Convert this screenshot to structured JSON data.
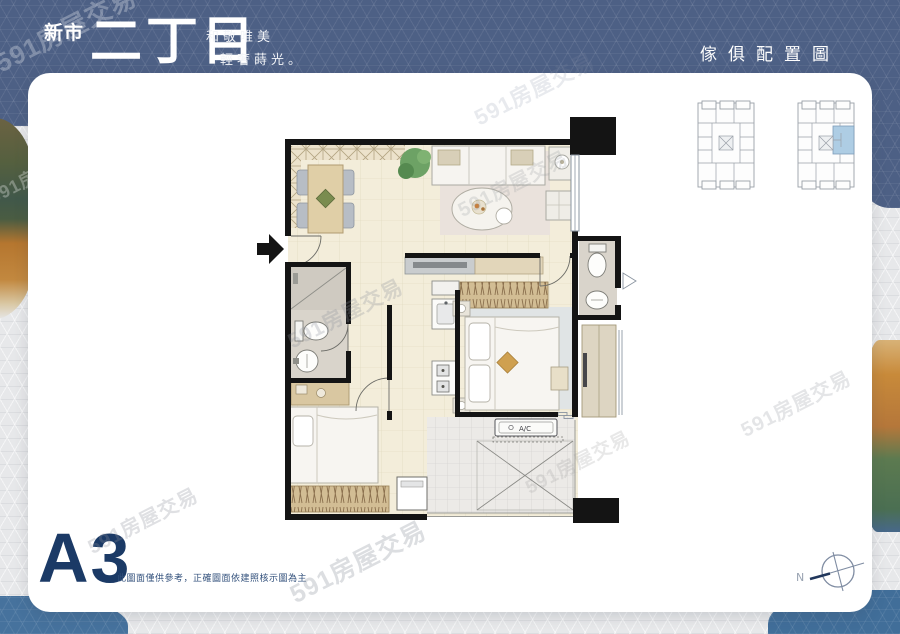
{
  "banner": {
    "location": "新市",
    "name": "二丁目",
    "slogan1": "和敬唯美",
    "slogan2": "輕奢蒔光。",
    "right_title": "傢俱配置圖"
  },
  "footer": {
    "unit": "A3",
    "disclaimer": "此圖面僅供參考，正確圖面依建照核示圖為主",
    "compass_label": "N"
  },
  "plan": {
    "ac_label": "A/C"
  },
  "watermark": {
    "text": "591房屋交易"
  },
  "key_plans": {
    "left": {
      "highlighted": "false"
    },
    "right": {
      "highlighted": "true"
    }
  },
  "colors": {
    "banner_blue": "#4d6085",
    "accent_navy": "#1b3a66",
    "highlight_unit": "#aecde4",
    "wall_black": "#141414",
    "floor_beige": "#f3edda"
  }
}
